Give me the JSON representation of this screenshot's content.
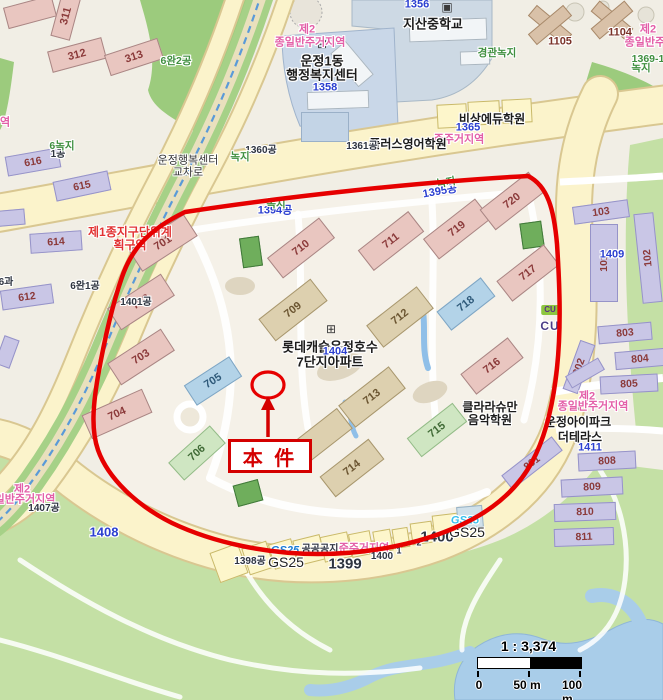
{
  "subject": {
    "label": "本 件"
  },
  "scale": {
    "ratio": "1 : 3,374",
    "ticks": [
      "0",
      "50 m",
      "100 m"
    ]
  },
  "colors": {
    "boundary_red": "#e60000",
    "subject_red": "#d40000",
    "zone_pink": "#e35fa8",
    "plan_red": "#e23333",
    "parcel_blue": "#2b3fd0",
    "greenery_green": "#3f8f3f"
  },
  "icons": [
    {
      "g": "⊞",
      "x": 322,
      "y": 44,
      "n": "apartment-icon"
    },
    {
      "g": "⊞",
      "x": 331,
      "y": 329,
      "n": "apartment-icon"
    },
    {
      "g": "⊞",
      "x": 578,
      "y": 406,
      "n": "apartment-icon"
    },
    {
      "g": "▣",
      "x": 447,
      "y": 7,
      "n": "school-icon"
    }
  ],
  "labels": [
    {
      "t": "제2",
      "x": 307,
      "y": 30,
      "c": "zone"
    },
    {
      "t": "종일반주거지역",
      "x": 310,
      "y": 43,
      "c": "zone"
    },
    {
      "t": "준주거지역",
      "x": 459,
      "y": 140,
      "c": "zone"
    },
    {
      "t": "제2",
      "x": 648,
      "y": 30,
      "c": "zone"
    },
    {
      "t": "종일반주거지",
      "x": 655,
      "y": 43,
      "c": "zone"
    },
    {
      "t": "제2",
      "x": 587,
      "y": 397,
      "c": "zone"
    },
    {
      "t": "종일반주거지역",
      "x": 593,
      "y": 407,
      "c": "zone"
    },
    {
      "t": "제2",
      "x": 22,
      "y": 490,
      "c": "zone"
    },
    {
      "t": "일반주거지역",
      "x": 25,
      "y": 500,
      "c": "zone"
    },
    {
      "t": "역",
      "x": 5,
      "y": 123,
      "c": "zone"
    },
    {
      "t": "준주거지역",
      "x": 364,
      "y": 549,
      "c": "zone"
    },
    {
      "t": "제1종지구단위계",
      "x": 130,
      "y": 232,
      "c": "plan"
    },
    {
      "t": "획구역",
      "x": 130,
      "y": 245,
      "c": "plan"
    },
    {
      "t": "지산중학교",
      "x": 433,
      "y": 24,
      "c": "place"
    },
    {
      "t": "운정1동",
      "x": 322,
      "y": 61,
      "c": "place"
    },
    {
      "t": "행정복지센터",
      "x": 322,
      "y": 75,
      "c": "place"
    },
    {
      "t": "롯데캐슬운정호수",
      "x": 330,
      "y": 347,
      "c": "place"
    },
    {
      "t": "7단지아파트",
      "x": 330,
      "y": 362,
      "c": "place"
    },
    {
      "t": "비상에듀학원",
      "x": 492,
      "y": 119,
      "c": "place2"
    },
    {
      "t": "플러스영어학원",
      "x": 408,
      "y": 144,
      "c": "place2"
    },
    {
      "t": "클라라슈만",
      "x": 490,
      "y": 407,
      "c": "place2"
    },
    {
      "t": "음악학원",
      "x": 490,
      "y": 420,
      "c": "place2"
    },
    {
      "t": "운정아이파크",
      "x": 578,
      "y": 422,
      "c": "place2"
    },
    {
      "t": "더테라스",
      "x": 580,
      "y": 437,
      "c": "place2"
    },
    {
      "t": "운정행복센터",
      "x": 188,
      "y": 161,
      "c": "place3"
    },
    {
      "t": "교차로",
      "x": 188,
      "y": 173,
      "c": "place3"
    },
    {
      "t": "CU",
      "x": 550,
      "y": 326,
      "c": "cu"
    },
    {
      "t": "1356",
      "x": 417,
      "y": 5,
      "c": "pnum"
    },
    {
      "t": "1358",
      "x": 325,
      "y": 88,
      "c": "pnum"
    },
    {
      "t": "1365",
      "x": 468,
      "y": 128,
      "c": "pnum"
    },
    {
      "t": "1394공",
      "x": 275,
      "y": 211,
      "c": "pnum"
    },
    {
      "t": "1395공",
      "x": 440,
      "y": 192,
      "c": "pnum",
      "r": -10
    },
    {
      "t": "1404",
      "x": 335,
      "y": 352,
      "c": "pnum"
    },
    {
      "t": "1409",
      "x": 612,
      "y": 255,
      "c": "pnum"
    },
    {
      "t": "1411",
      "x": 590,
      "y": 448,
      "c": "pnum"
    },
    {
      "t": "1408",
      "x": 104,
      "y": 532,
      "c": "pnum",
      "s": 13
    },
    {
      "t": "1360공",
      "x": 261,
      "y": 151,
      "c": "pdark"
    },
    {
      "t": "1361공",
      "x": 362,
      "y": 147,
      "c": "pdark"
    },
    {
      "t": "1401공",
      "x": 136,
      "y": 303,
      "c": "pdark"
    },
    {
      "t": "6완1공",
      "x": 85,
      "y": 287,
      "c": "pdark"
    },
    {
      "t": "1407공",
      "x": 44,
      "y": 509,
      "c": "pdark"
    },
    {
      "t": "1398공",
      "x": 250,
      "y": 562,
      "c": "pdark"
    },
    {
      "t": "1399",
      "x": 345,
      "y": 564,
      "c": "pdark",
      "s": 15
    },
    {
      "t": "1400",
      "x": 382,
      "y": 557,
      "c": "pdark"
    },
    {
      "t": "1",
      "x": 399,
      "y": 551,
      "c": "pdark",
      "s": 9
    },
    {
      "t": "2",
      "x": 419,
      "y": 543,
      "c": "pdark",
      "s": 9
    },
    {
      "t": "1400",
      "x": 437,
      "y": 537,
      "c": "pdark",
      "s": 15
    },
    {
      "t": "공공공지",
      "x": 320,
      "y": 550,
      "c": "pdark"
    },
    {
      "t": "1공",
      "x": 58,
      "y": 155,
      "c": "pdark"
    },
    {
      "t": "6과",
      "x": 6,
      "y": 283,
      "c": "pdark"
    },
    {
      "t": "녹지",
      "x": 240,
      "y": 157,
      "c": "grn"
    },
    {
      "t": "녹지",
      "x": 276,
      "y": 204,
      "c": "grn"
    },
    {
      "t": "녹지",
      "x": 446,
      "y": 183,
      "c": "grn",
      "r": -10
    },
    {
      "t": "녹지",
      "x": 641,
      "y": 68,
      "c": "grn"
    },
    {
      "t": "경관녹지",
      "x": 497,
      "y": 53,
      "c": "grn"
    },
    {
      "t": "6완2공",
      "x": 176,
      "y": 61,
      "c": "grn"
    },
    {
      "t": "6녹지",
      "x": 62,
      "y": 146,
      "c": "grn"
    },
    {
      "t": "1369-1",
      "x": 648,
      "y": 59,
      "c": "grn"
    },
    {
      "t": "GS25",
      "x": 285,
      "y": 551,
      "c": "gsb"
    },
    {
      "t": "GS25",
      "x": 286,
      "y": 562,
      "c": "gsd"
    },
    {
      "t": "GS25",
      "x": 465,
      "y": 521,
      "c": "gsc"
    },
    {
      "t": "GS25",
      "x": 467,
      "y": 532,
      "c": "gsd"
    },
    {
      "t": "1105",
      "x": 560,
      "y": 42,
      "c": "bn"
    },
    {
      "t": "1104",
      "x": 620,
      "y": 33,
      "c": "bn"
    }
  ],
  "buildings": [
    {
      "n": "",
      "x": 30,
      "y": 12,
      "w": 50,
      "h": 22,
      "r": -15,
      "t": "p"
    },
    {
      "n": "311",
      "x": 66,
      "y": 16,
      "w": 46,
      "h": 20,
      "r": -75,
      "t": "p"
    },
    {
      "n": "312",
      "x": 77,
      "y": 55,
      "w": 56,
      "h": 22,
      "r": -15,
      "t": "p"
    },
    {
      "n": "313",
      "x": 134,
      "y": 57,
      "w": 56,
      "h": 22,
      "r": -18,
      "t": "p"
    },
    {
      "n": "616",
      "x": 33,
      "y": 162,
      "w": 54,
      "h": 20,
      "r": -10,
      "t": "v"
    },
    {
      "n": "615",
      "x": 82,
      "y": 186,
      "w": 56,
      "h": 20,
      "r": -12,
      "t": "v"
    },
    {
      "n": "614",
      "x": 56,
      "y": 242,
      "w": 52,
      "h": 20,
      "r": -4,
      "t": "v"
    },
    {
      "n": "612",
      "x": 27,
      "y": 297,
      "w": 52,
      "h": 20,
      "r": -8,
      "t": "v"
    },
    {
      "n": "",
      "x": 8,
      "y": 218,
      "w": 34,
      "h": 16,
      "r": -5,
      "t": "v"
    },
    {
      "n": "",
      "x": 7,
      "y": 352,
      "w": 30,
      "h": 16,
      "r": -70,
      "t": "v"
    },
    {
      "n": "701",
      "x": 163,
      "y": 243,
      "w": 66,
      "h": 26,
      "r": -33,
      "t": "p"
    },
    {
      "n": "702",
      "x": 141,
      "y": 302,
      "w": 64,
      "h": 26,
      "r": -33,
      "t": "p"
    },
    {
      "n": "703",
      "x": 141,
      "y": 357,
      "w": 64,
      "h": 26,
      "r": -33,
      "t": "p"
    },
    {
      "n": "704",
      "x": 117,
      "y": 414,
      "w": 66,
      "h": 26,
      "r": -24,
      "t": "p"
    },
    {
      "n": "705",
      "x": 213,
      "y": 381,
      "w": 54,
      "h": 24,
      "r": -33,
      "t": "b"
    },
    {
      "n": "706",
      "x": 197,
      "y": 453,
      "w": 56,
      "h": 24,
      "r": -42,
      "t": "g"
    },
    {
      "n": "709",
      "x": 293,
      "y": 310,
      "w": 66,
      "h": 28,
      "r": -38,
      "t": "t"
    },
    {
      "n": "710",
      "x": 301,
      "y": 248,
      "w": 66,
      "h": 26,
      "r": -38,
      "t": "p"
    },
    {
      "n": "711",
      "x": 391,
      "y": 241,
      "w": 64,
      "h": 26,
      "r": -38,
      "t": "p"
    },
    {
      "n": "712",
      "x": 400,
      "y": 317,
      "w": 64,
      "h": 28,
      "r": -38,
      "t": "t"
    },
    {
      "n": "713",
      "x": 372,
      "y": 397,
      "w": 64,
      "h": 28,
      "r": -38,
      "t": "t"
    },
    {
      "n": "714",
      "x": 352,
      "y": 468,
      "w": 62,
      "h": 26,
      "r": -38,
      "t": "t"
    },
    {
      "n": "",
      "x": 322,
      "y": 436,
      "w": 58,
      "h": 26,
      "r": -38,
      "t": "t"
    },
    {
      "n": "715",
      "x": 437,
      "y": 430,
      "w": 58,
      "h": 24,
      "r": -38,
      "t": "g"
    },
    {
      "n": "716",
      "x": 492,
      "y": 366,
      "w": 60,
      "h": 26,
      "r": -38,
      "t": "p"
    },
    {
      "n": "717",
      "x": 528,
      "y": 273,
      "w": 60,
      "h": 26,
      "r": -38,
      "t": "p"
    },
    {
      "n": "718",
      "x": 466,
      "y": 304,
      "w": 56,
      "h": 24,
      "r": -38,
      "t": "b"
    },
    {
      "n": "719",
      "x": 457,
      "y": 229,
      "w": 66,
      "h": 26,
      "r": -38,
      "t": "p"
    },
    {
      "n": "720",
      "x": 512,
      "y": 201,
      "w": 62,
      "h": 26,
      "r": -38,
      "t": "p"
    },
    {
      "n": "",
      "x": 550,
      "y": 25,
      "w": 46,
      "h": 14,
      "r": 40,
      "t": "n"
    },
    {
      "n": "",
      "x": 550,
      "y": 25,
      "w": 46,
      "h": 14,
      "r": -40,
      "t": "n"
    },
    {
      "n": "",
      "x": 612,
      "y": 20,
      "w": 44,
      "h": 14,
      "r": 40,
      "t": "n"
    },
    {
      "n": "",
      "x": 612,
      "y": 20,
      "w": 44,
      "h": 14,
      "r": -40,
      "t": "n"
    },
    {
      "n": "103",
      "x": 601,
      "y": 212,
      "w": 56,
      "h": 18,
      "r": -8,
      "t": "v"
    },
    {
      "n": "101",
      "x": 604,
      "y": 263,
      "w": 28,
      "h": 78,
      "r": 0,
      "t": "v",
      "lr": -90
    },
    {
      "n": "102",
      "x": 648,
      "y": 258,
      "w": 20,
      "h": 90,
      "r": -6,
      "t": "v",
      "lr": -90
    },
    {
      "n": "801",
      "x": 532,
      "y": 463,
      "w": 64,
      "h": 18,
      "r": -38,
      "t": "v"
    },
    {
      "n": "802",
      "x": 579,
      "y": 367,
      "w": 52,
      "h": 16,
      "r": -70,
      "t": "v"
    },
    {
      "n": "803",
      "x": 625,
      "y": 333,
      "w": 54,
      "h": 18,
      "r": -5,
      "t": "v"
    },
    {
      "n": "804",
      "x": 640,
      "y": 359,
      "w": 50,
      "h": 18,
      "r": -5,
      "t": "v"
    },
    {
      "n": "805",
      "x": 629,
      "y": 384,
      "w": 58,
      "h": 18,
      "r": -3,
      "t": "v"
    },
    {
      "n": "",
      "x": 585,
      "y": 373,
      "w": 38,
      "h": 14,
      "r": -30,
      "t": "v"
    },
    {
      "n": "808",
      "x": 607,
      "y": 461,
      "w": 58,
      "h": 18,
      "r": -3,
      "t": "v"
    },
    {
      "n": "809",
      "x": 592,
      "y": 487,
      "w": 62,
      "h": 18,
      "r": -3,
      "t": "v"
    },
    {
      "n": "810",
      "x": 585,
      "y": 512,
      "w": 62,
      "h": 18,
      "r": -2,
      "t": "v"
    },
    {
      "n": "811",
      "x": 584,
      "y": 537,
      "w": 60,
      "h": 18,
      "r": -2,
      "t": "v"
    },
    {
      "n": "",
      "x": 448,
      "y": 30,
      "w": 78,
      "h": 22,
      "r": -2,
      "t": "c"
    },
    {
      "n": "",
      "x": 475,
      "y": 58,
      "w": 30,
      "h": 14,
      "r": -2,
      "t": "c"
    },
    {
      "n": "",
      "x": 338,
      "y": 100,
      "w": 62,
      "h": 18,
      "r": -2,
      "t": "c"
    },
    {
      "n": "",
      "x": 352,
      "y": 64,
      "w": 20,
      "h": 44,
      "r": -40,
      "t": "c"
    }
  ],
  "parcels": [
    {
      "x": 229,
      "y": 563,
      "w": 30,
      "h": 32,
      "r": -20
    },
    {
      "x": 258,
      "y": 558,
      "w": 26,
      "h": 28,
      "r": -18
    },
    {
      "x": 283,
      "y": 554,
      "w": 24,
      "h": 26,
      "r": -16
    },
    {
      "x": 309,
      "y": 550,
      "w": 28,
      "h": 26,
      "r": -14
    },
    {
      "x": 336,
      "y": 547,
      "w": 28,
      "h": 26,
      "r": -12
    },
    {
      "x": 361,
      "y": 544,
      "w": 22,
      "h": 24,
      "r": -11
    },
    {
      "x": 383,
      "y": 541,
      "w": 18,
      "h": 22,
      "r": -10
    },
    {
      "x": 401,
      "y": 538,
      "w": 16,
      "h": 20,
      "r": -9
    },
    {
      "x": 422,
      "y": 533,
      "w": 22,
      "h": 22,
      "r": -8
    },
    {
      "x": 447,
      "y": 526,
      "w": 28,
      "h": 24,
      "r": -7
    },
    {
      "x": 470,
      "y": 517,
      "w": 26,
      "h": 22,
      "r": -5,
      "f": "pf-b"
    },
    {
      "x": 452,
      "y": 116,
      "w": 30,
      "h": 24,
      "r": -3
    },
    {
      "x": 484,
      "y": 113,
      "w": 32,
      "h": 24,
      "r": -3
    },
    {
      "x": 517,
      "y": 111,
      "w": 30,
      "h": 24,
      "r": -3
    },
    {
      "x": 325,
      "y": 127,
      "w": 48,
      "h": 30,
      "r": 0,
      "f": "pf-c"
    }
  ],
  "facilities": [
    {
      "x": 251,
      "y": 252,
      "w": 20,
      "h": 30,
      "r": -8
    },
    {
      "x": 532,
      "y": 235,
      "w": 22,
      "h": 26,
      "r": -8
    },
    {
      "x": 248,
      "y": 493,
      "w": 26,
      "h": 22,
      "r": -15
    }
  ],
  "stores": {
    "cu_badge": "CU"
  }
}
